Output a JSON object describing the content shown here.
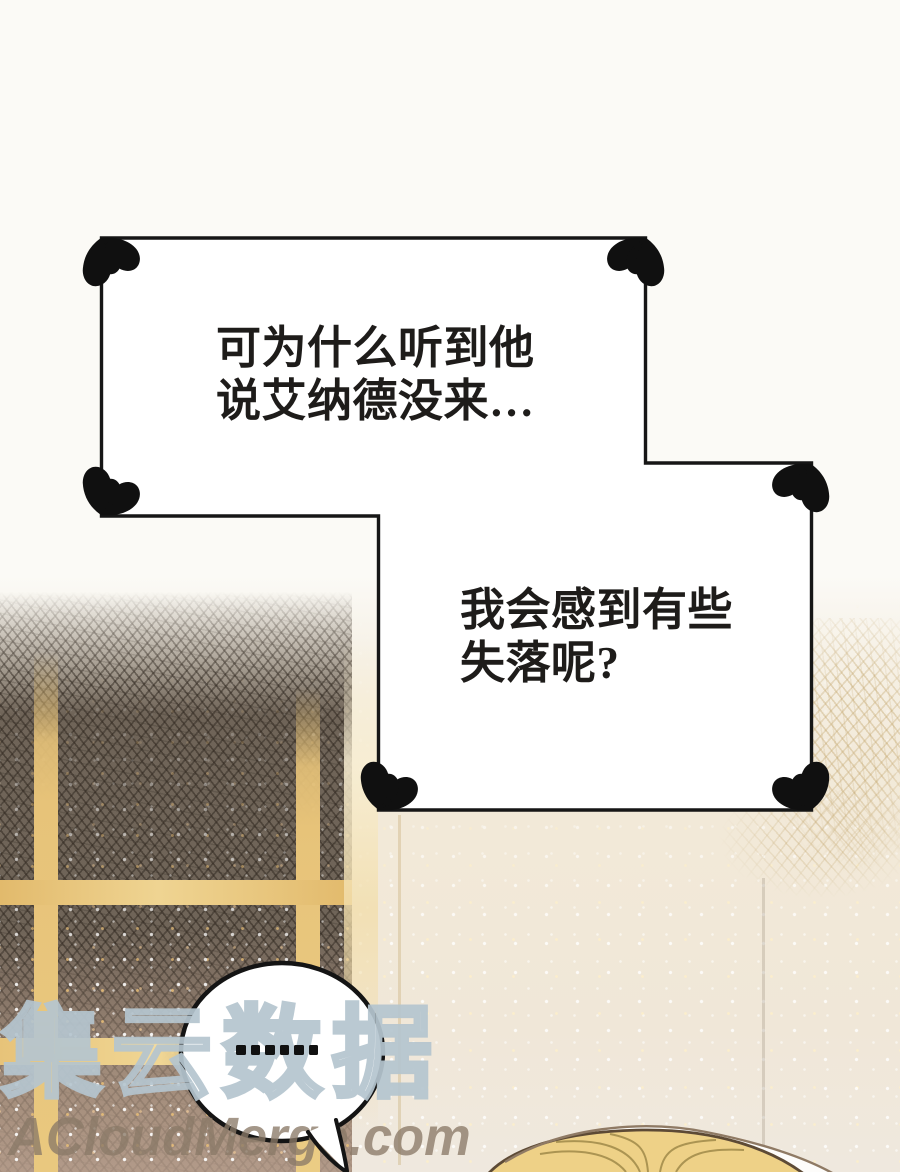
{
  "panel": {
    "thought_box": {
      "line1": "可为什么听到他",
      "line2": "说艾纳德没来…",
      "line3": "我会感到有些",
      "line4": "失落呢?"
    },
    "speech_bubble": {
      "ellipsis": "……",
      "dot_count": 6
    },
    "watermark": {
      "cn": "集云数据",
      "en": "ACloudMerge.com"
    },
    "colors": {
      "ink": "#1c1c1c",
      "paper": "#fbfaf6",
      "cream": "#f2e9d8",
      "window_dark": "#6f6458",
      "gold_frame": "#e7c379",
      "hair": "#eed187",
      "hair_outline": "#5d4a35",
      "watermark_outline": "#b4c4ce",
      "watermark_en_color": "#8a7a68"
    }
  }
}
